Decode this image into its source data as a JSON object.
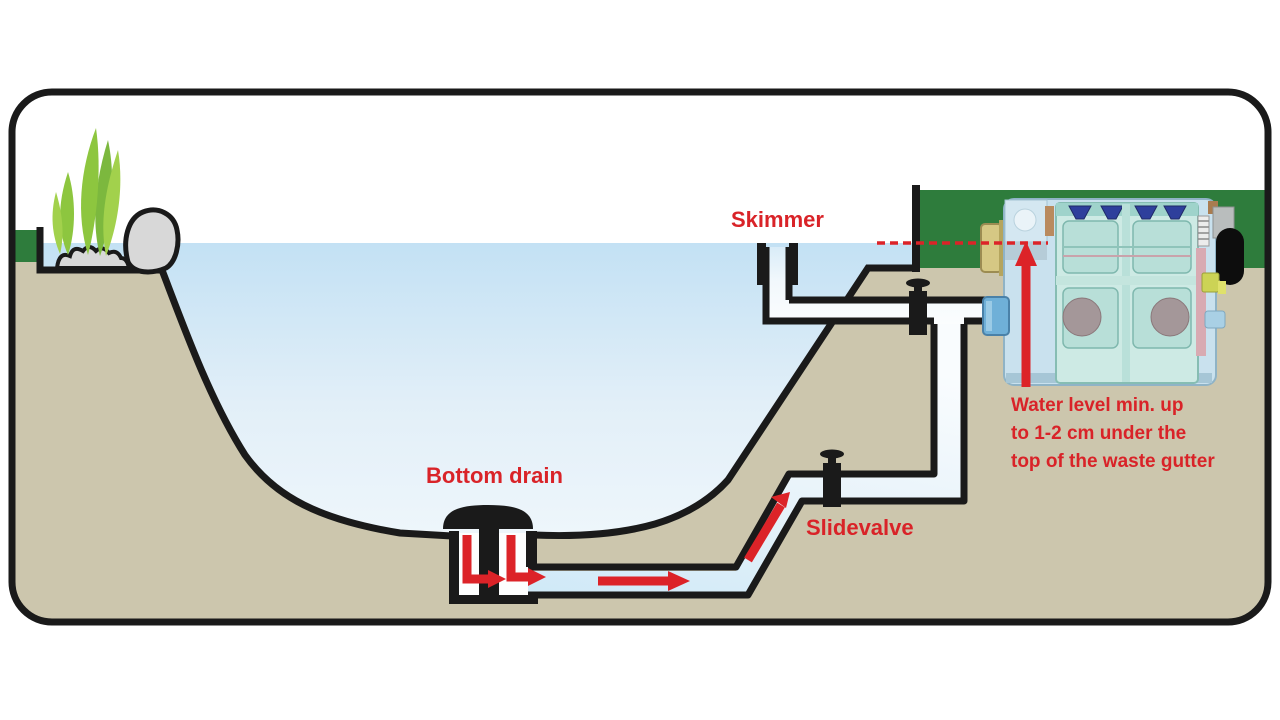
{
  "diagram": {
    "title_implied": "Pond gravity filtration schematic",
    "labels": {
      "skimmer": "Skimmer",
      "bottom_drain": "Bottom drain",
      "slidevalve": "Slidevalve",
      "water_level_note": {
        "line1": "Water level min. up",
        "line2": "to 1-2 cm under the",
        "line3": "top of the waste gutter"
      }
    },
    "colors": {
      "annotation_red": "#D92328",
      "outline_black": "#1A1A1A",
      "ground_tan": "#CCC6AD",
      "grass_green": "#2E7C3C",
      "water_top": "#C3E1F4",
      "water_bottom": "#EEF6FB",
      "pipe_water": "#CFE9F7",
      "plant_green": "#8DC63F",
      "stone_grey": "#D8D8D8",
      "filter_body_blue": "#C9E1EE",
      "filter_drum_teal": "#CDEAE4",
      "filter_inlet_gold": "#D6C884",
      "filter_inlet_blue": "#6FB0D8"
    },
    "icons": [
      "skimmer-icon",
      "bottom-drain-icon",
      "slide-valve-icon",
      "drum-filter-icon",
      "flow-arrow-icon",
      "plant-icon",
      "rock-icon"
    ]
  }
}
